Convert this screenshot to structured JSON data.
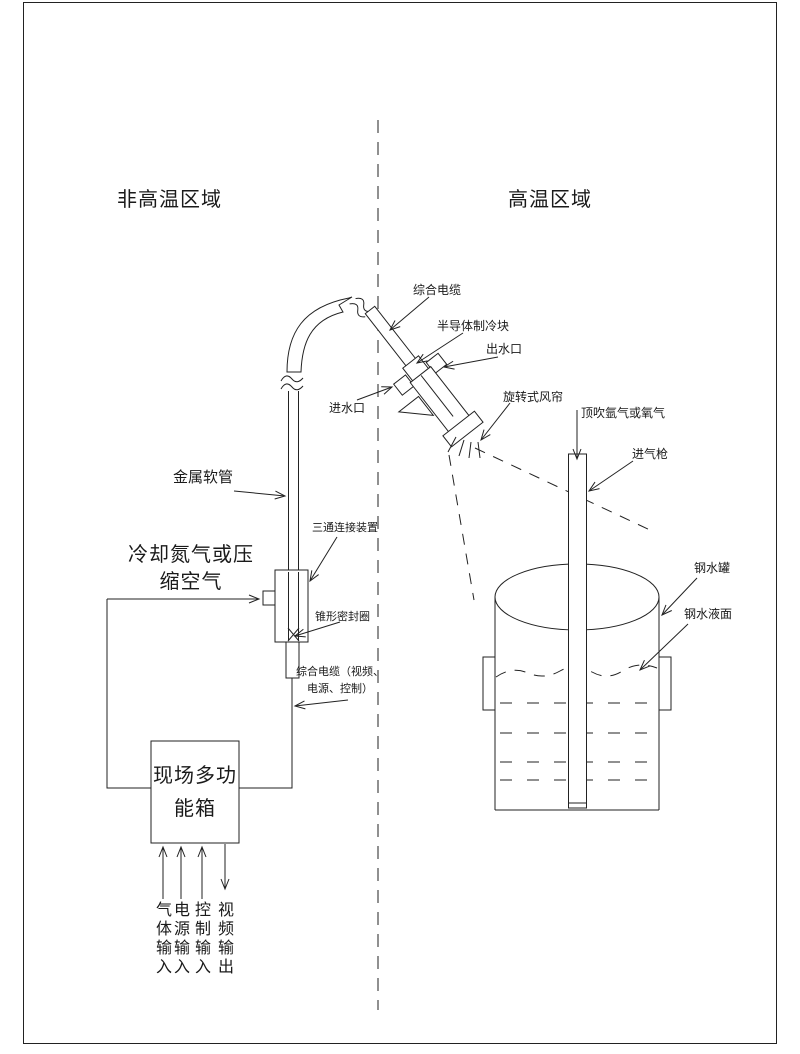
{
  "zones": {
    "non_high_temp": "非高温区域",
    "high_temp": "高温区域"
  },
  "labels": {
    "integrated_cable": "综合电缆",
    "semiconductor_cooling_block": "半导体制冷块",
    "water_outlet": "出水口",
    "water_inlet": "进水口",
    "rotary_air_curtain": "旋转式风帘",
    "top_blown_gas": "顶吹氩气或氧气",
    "gas_lance": "进气枪",
    "ladle": "钢水罐",
    "steel_level": "钢水液面",
    "metal_hose": "金属软管",
    "tee_connector": "三通连接装置",
    "cooling_gas": "冷却氮气或压\n缩空气",
    "conical_seal_ring": "锥形密封圈",
    "integrated_cable_detail": "综合电缆（视频、\n电源、控制）",
    "field_multifunction_box": "现场多功\n能箱"
  },
  "io_ports": [
    "气\n体\n输\n入",
    "电\n源\n输\n入",
    "控\n制\n输\n入",
    "视\n频\n输\n出"
  ],
  "colors": {
    "line": "#222222",
    "frame": "#999999",
    "background": "#ffffff"
  }
}
